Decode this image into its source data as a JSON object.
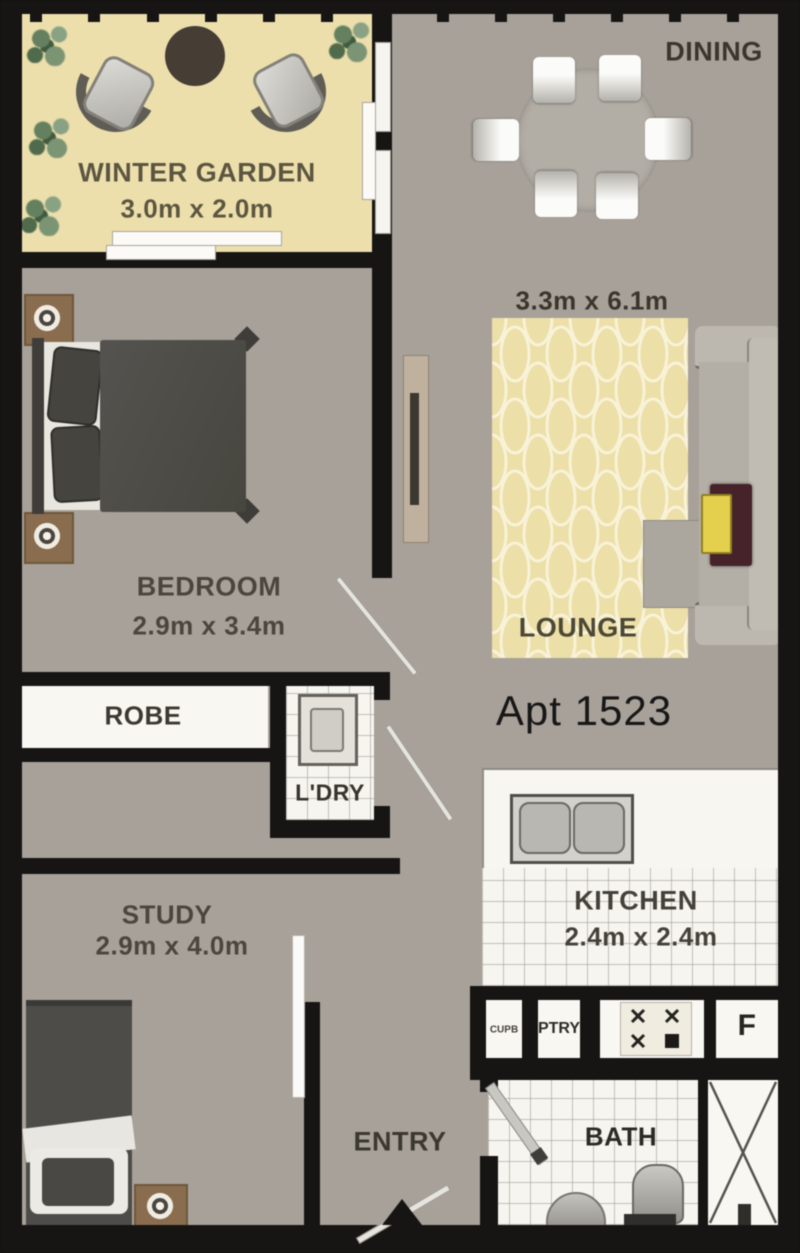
{
  "apartment": {
    "number_label": "Apt 1523"
  },
  "palette": {
    "wall": "#161513",
    "floor": "#a7a199",
    "winter_garden_floor": "#ecdfac",
    "rug": "#ecdfa8",
    "rug_pattern": "#f8f2d8",
    "tile_white": "#f6f5ef",
    "sofa_gray": "#bcb8b0",
    "bed_dark": "#4b4a46",
    "timber": "#8a6d4e",
    "table_dark": "#46232a",
    "cushion_yellow": "#e5d04e",
    "label_dark": "#3a362d",
    "label_olive": "#5c5640"
  },
  "rooms": {
    "winter_garden": {
      "name": "WINTER GARDEN",
      "dims": "3.0m x 2.0m"
    },
    "dining": {
      "name": "DINING"
    },
    "lounge": {
      "name": "LOUNGE",
      "dims": "3.3m x 6.1m"
    },
    "bedroom": {
      "name": "BEDROOM",
      "dims": "2.9m x 3.4m"
    },
    "robe": {
      "name": "ROBE"
    },
    "laundry": {
      "name": "L'DRY"
    },
    "kitchen": {
      "name": "KITCHEN",
      "dims": "2.4m x 2.4m"
    },
    "cupboard": {
      "name": "CUPB"
    },
    "pantry": {
      "name": "PTRY"
    },
    "fridge": {
      "name": "F"
    },
    "bath": {
      "name": "BATH"
    },
    "entry": {
      "name": "ENTRY"
    },
    "study": {
      "name": "STUDY",
      "dims": "2.9m x 4.0m"
    }
  }
}
